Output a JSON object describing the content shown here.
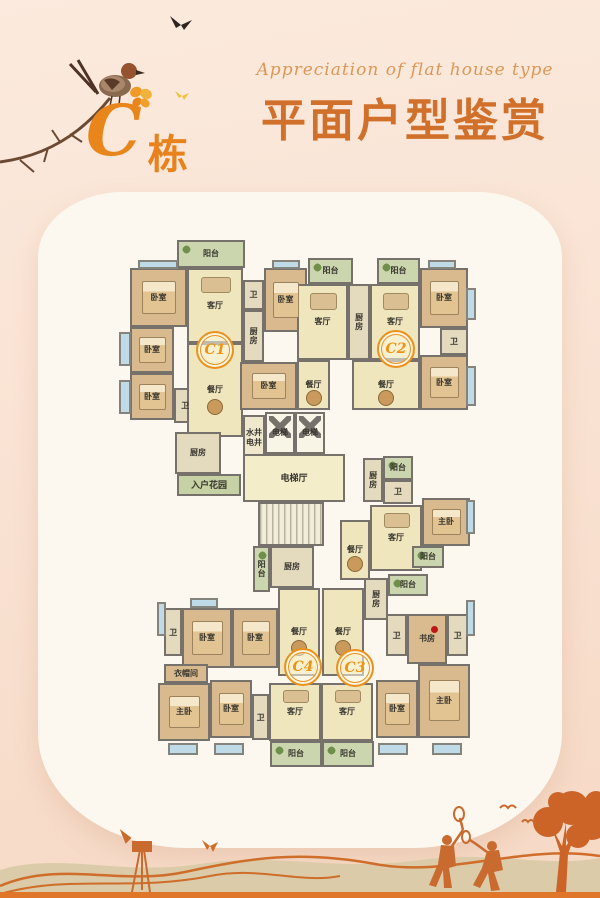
{
  "header": {
    "subtitle_en": "Appreciation of flat house type",
    "title_zh": "平面户型鉴赏",
    "building_letter": "C",
    "building_suffix": "栋",
    "title_color": "#d0702a",
    "accent_orange": "#e8861c"
  },
  "floorplan": {
    "wall_color": "#76716a",
    "badge_color": "#ef9210",
    "palette": {
      "living": "#f0e6bd",
      "dining": "#f0e6bd",
      "hall": "#f4edca",
      "bedroom": "#d8ba8e",
      "master": "#d8ba8e",
      "study": "#d9bb8f",
      "cloak": "#d8ba8e",
      "kitchen": "#e4dabd",
      "bath": "#e4dabd",
      "balcony": "#ccd6ae",
      "garden": "#c6d1a4",
      "elevator": "#f8f4e6",
      "well": "#efe8cc",
      "stairs": "#f2edd8"
    },
    "badges": [
      {
        "label": "C1",
        "cx": 213,
        "cy": 348
      },
      {
        "label": "C2",
        "cx": 394,
        "cy": 347
      },
      {
        "label": "C4",
        "cx": 301,
        "cy": 665
      },
      {
        "label": "C3",
        "cy": 666,
        "cx": 353
      }
    ],
    "rooms": [
      {
        "label": "阳台",
        "type": "balcony",
        "x": 177,
        "y": 240,
        "w": 68,
        "h": 28
      },
      {
        "label": "卧室",
        "type": "bedroom",
        "x": 130,
        "y": 268,
        "w": 57,
        "h": 59
      },
      {
        "label": "卧室",
        "type": "bedroom",
        "x": 130,
        "y": 327,
        "w": 44,
        "h": 46
      },
      {
        "label": "卧室",
        "type": "bedroom",
        "x": 130,
        "y": 373,
        "w": 44,
        "h": 47
      },
      {
        "label": "卫",
        "type": "bath",
        "x": 174,
        "y": 388,
        "w": 22,
        "h": 35,
        "v": true
      },
      {
        "label": "客厅",
        "type": "living",
        "x": 187,
        "y": 268,
        "w": 56,
        "h": 75
      },
      {
        "label": "餐厅",
        "type": "dining",
        "x": 187,
        "y": 343,
        "w": 56,
        "h": 94
      },
      {
        "label": "卫",
        "type": "bath",
        "x": 243,
        "y": 280,
        "w": 21,
        "h": 30
      },
      {
        "label": "厨房",
        "type": "kitchen",
        "x": 243,
        "y": 310,
        "w": 21,
        "h": 52,
        "v": true
      },
      {
        "label": "卧室",
        "type": "bedroom",
        "x": 264,
        "y": 268,
        "w": 43,
        "h": 64
      },
      {
        "label": "卧室",
        "type": "bedroom",
        "x": 240,
        "y": 362,
        "w": 57,
        "h": 48
      },
      {
        "label": "餐厅",
        "type": "dining",
        "x": 297,
        "y": 360,
        "w": 33,
        "h": 50
      },
      {
        "label": "阳台",
        "type": "balcony",
        "x": 308,
        "y": 258,
        "w": 45,
        "h": 26
      },
      {
        "label": "客厅",
        "type": "living",
        "x": 297,
        "y": 284,
        "w": 51,
        "h": 76
      },
      {
        "label": "厨房",
        "type": "kitchen",
        "x": 348,
        "y": 284,
        "w": 22,
        "h": 76,
        "v": true
      },
      {
        "label": "阳台",
        "type": "balcony",
        "x": 377,
        "y": 258,
        "w": 43,
        "h": 26
      },
      {
        "label": "客厅",
        "type": "living",
        "x": 370,
        "y": 284,
        "w": 50,
        "h": 76
      },
      {
        "label": "餐厅",
        "type": "dining",
        "x": 352,
        "y": 360,
        "w": 68,
        "h": 50
      },
      {
        "label": "卧室",
        "type": "bedroom",
        "x": 420,
        "y": 268,
        "w": 48,
        "h": 60
      },
      {
        "label": "卫",
        "type": "bath",
        "x": 440,
        "y": 328,
        "w": 28,
        "h": 27
      },
      {
        "label": "卧室",
        "type": "bedroom",
        "x": 420,
        "y": 355,
        "w": 48,
        "h": 55
      },
      {
        "label": "水井\n电井",
        "type": "well",
        "x": 243,
        "y": 415,
        "w": 22,
        "h": 45
      },
      {
        "label": "电梯",
        "type": "elevator",
        "x": 265,
        "y": 412,
        "w": 30,
        "h": 42
      },
      {
        "label": "电梯",
        "type": "elevator",
        "x": 295,
        "y": 412,
        "w": 30,
        "h": 42
      },
      {
        "label": "电梯厅",
        "type": "hall",
        "x": 243,
        "y": 454,
        "w": 102,
        "h": 48
      },
      {
        "label": "",
        "type": "stairs",
        "x": 258,
        "y": 502,
        "w": 66,
        "h": 44
      },
      {
        "label": "厨房",
        "type": "kitchen",
        "x": 175,
        "y": 432,
        "w": 46,
        "h": 42
      },
      {
        "label": "入户花园",
        "type": "garden",
        "x": 177,
        "y": 474,
        "w": 64,
        "h": 22
      },
      {
        "label": "厨房",
        "type": "kitchen",
        "x": 363,
        "y": 458,
        "w": 20,
        "h": 44,
        "v": true
      },
      {
        "label": "阳台",
        "type": "balcony",
        "x": 383,
        "y": 456,
        "w": 30,
        "h": 24
      },
      {
        "label": "卫",
        "type": "bath",
        "x": 383,
        "y": 480,
        "w": 30,
        "h": 24
      },
      {
        "label": "餐厅",
        "type": "dining",
        "x": 340,
        "y": 520,
        "w": 30,
        "h": 60
      },
      {
        "label": "客厅",
        "type": "living",
        "x": 370,
        "y": 505,
        "w": 52,
        "h": 66
      },
      {
        "label": "主卧",
        "type": "master",
        "x": 422,
        "y": 498,
        "w": 48,
        "h": 48
      },
      {
        "label": "阳台",
        "type": "balcony",
        "x": 412,
        "y": 546,
        "w": 32,
        "h": 22
      },
      {
        "label": "阳台",
        "type": "balcony",
        "x": 253,
        "y": 546,
        "w": 17,
        "h": 46,
        "v": true
      },
      {
        "label": "厨房",
        "type": "kitchen",
        "x": 270,
        "y": 546,
        "w": 44,
        "h": 42
      },
      {
        "label": "卫",
        "type": "bath",
        "x": 164,
        "y": 608,
        "w": 18,
        "h": 48,
        "v": true
      },
      {
        "label": "卧室",
        "type": "bedroom",
        "x": 182,
        "y": 608,
        "w": 50,
        "h": 60
      },
      {
        "label": "卧室",
        "type": "bedroom",
        "x": 232,
        "y": 608,
        "w": 46,
        "h": 60
      },
      {
        "label": "餐厅",
        "type": "dining",
        "x": 278,
        "y": 588,
        "w": 42,
        "h": 88
      },
      {
        "label": "衣帽间",
        "type": "cloak",
        "x": 164,
        "y": 664,
        "w": 44,
        "h": 19
      },
      {
        "label": "主卧",
        "type": "master",
        "x": 158,
        "y": 683,
        "w": 52,
        "h": 58
      },
      {
        "label": "卧室",
        "type": "bedroom",
        "x": 210,
        "y": 680,
        "w": 42,
        "h": 58
      },
      {
        "label": "卫",
        "type": "bath",
        "x": 252,
        "y": 694,
        "w": 17,
        "h": 46,
        "v": true
      },
      {
        "label": "客厅",
        "type": "living",
        "x": 269,
        "y": 683,
        "w": 52,
        "h": 58
      },
      {
        "label": "阳台",
        "type": "balcony",
        "x": 270,
        "y": 741,
        "w": 52,
        "h": 26
      },
      {
        "label": "餐厅",
        "type": "dining",
        "x": 322,
        "y": 588,
        "w": 42,
        "h": 88
      },
      {
        "label": "厨房",
        "type": "kitchen",
        "x": 364,
        "y": 578,
        "w": 24,
        "h": 42,
        "v": true
      },
      {
        "label": "阳台",
        "type": "balcony",
        "x": 388,
        "y": 574,
        "w": 40,
        "h": 22
      },
      {
        "label": "卫",
        "type": "bath",
        "x": 386,
        "y": 614,
        "w": 21,
        "h": 42,
        "v": true
      },
      {
        "label": "书房",
        "type": "study",
        "x": 407,
        "y": 614,
        "w": 40,
        "h": 50
      },
      {
        "label": "卫",
        "type": "bath",
        "x": 447,
        "y": 614,
        "w": 21,
        "h": 42,
        "v": true
      },
      {
        "label": "主卧",
        "type": "master",
        "x": 418,
        "y": 664,
        "w": 52,
        "h": 74
      },
      {
        "label": "卧室",
        "type": "bedroom",
        "x": 376,
        "y": 680,
        "w": 42,
        "h": 58
      },
      {
        "label": "客厅",
        "type": "living",
        "x": 321,
        "y": 683,
        "w": 52,
        "h": 58
      },
      {
        "label": "阳台",
        "type": "balcony",
        "x": 322,
        "y": 741,
        "w": 52,
        "h": 26
      }
    ],
    "windows": [
      {
        "x": 138,
        "y": 260,
        "w": 40,
        "h": 9
      },
      {
        "x": 272,
        "y": 260,
        "w": 28,
        "h": 9
      },
      {
        "x": 428,
        "y": 260,
        "w": 28,
        "h": 9
      },
      {
        "x": 119,
        "y": 332,
        "w": 12,
        "h": 34
      },
      {
        "x": 119,
        "y": 380,
        "w": 12,
        "h": 34
      },
      {
        "x": 466,
        "y": 288,
        "w": 10,
        "h": 32
      },
      {
        "x": 466,
        "y": 366,
        "w": 10,
        "h": 40
      },
      {
        "x": 466,
        "y": 500,
        "w": 9,
        "h": 34
      },
      {
        "x": 190,
        "y": 598,
        "w": 28,
        "h": 10
      },
      {
        "x": 157,
        "y": 602,
        "w": 9,
        "h": 34
      },
      {
        "x": 466,
        "y": 600,
        "w": 9,
        "h": 36
      },
      {
        "x": 168,
        "y": 743,
        "w": 30,
        "h": 12
      },
      {
        "x": 214,
        "y": 743,
        "w": 30,
        "h": 12
      },
      {
        "x": 378,
        "y": 743,
        "w": 30,
        "h": 12
      },
      {
        "x": 432,
        "y": 743,
        "w": 30,
        "h": 12
      }
    ]
  },
  "footer": {
    "silhouette_color": "#cc6a2a",
    "mountain_color": "#dbcba8",
    "strip_color": "#e07629"
  }
}
